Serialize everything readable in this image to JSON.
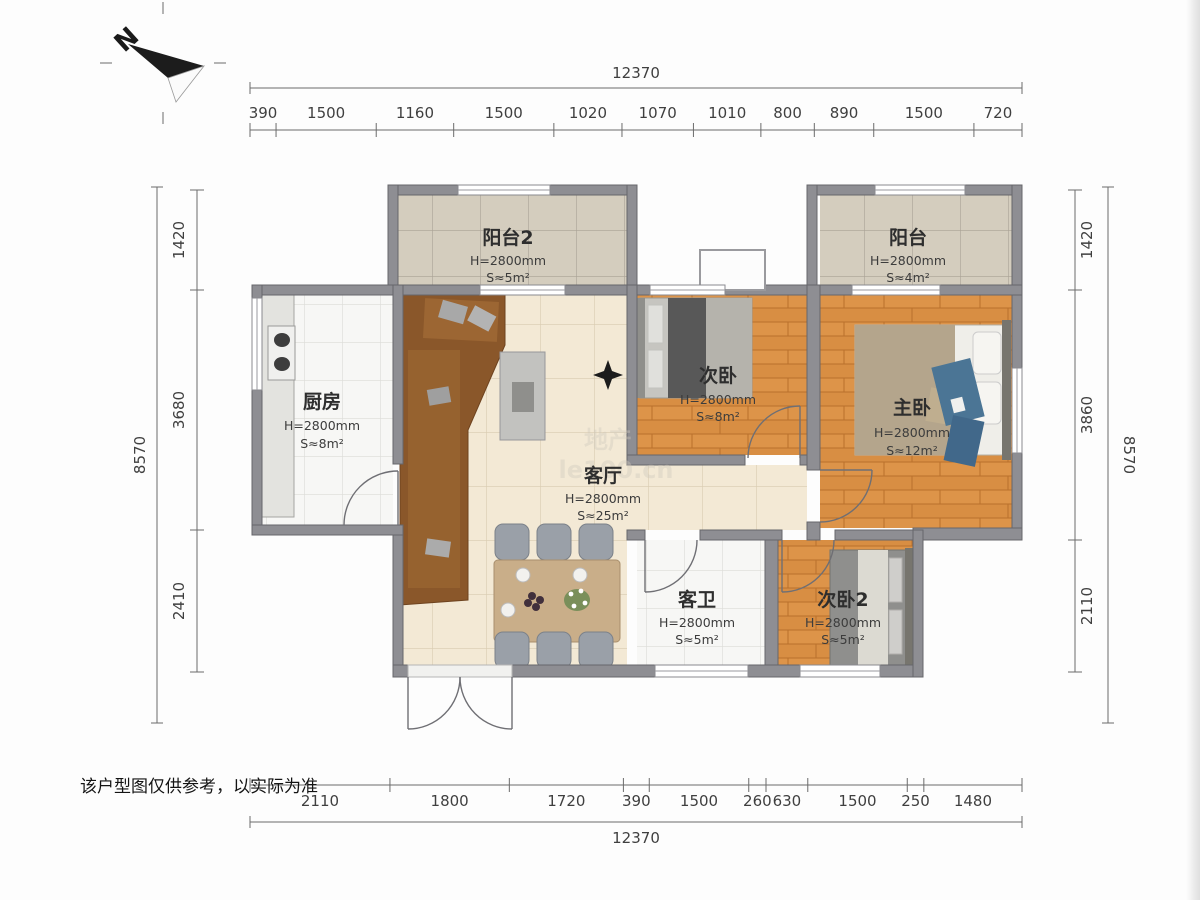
{
  "compass": {
    "n": "N"
  },
  "disclaimer": "该户型图仅供参考，以实际为准",
  "watermark": {
    "line1": "地产",
    "line2": "le100.cn"
  },
  "rooms": {
    "balcony2": {
      "name": "阳台2",
      "height": "H=2800mm",
      "area": "S≈5m²"
    },
    "balcony": {
      "name": "阳台",
      "height": "H=2800mm",
      "area": "S≈4m²"
    },
    "kitchen": {
      "name": "厨房",
      "height": "H=2800mm",
      "area": "S≈8m²"
    },
    "bedroom2": {
      "name": "次卧",
      "height": "H=2800mm",
      "area": "S≈8m²"
    },
    "master": {
      "name": "主卧",
      "height": "H=2800mm",
      "area": "S≈12m²"
    },
    "living": {
      "name": "客厅",
      "height": "H=2800mm",
      "area": "S≈25m²"
    },
    "bath": {
      "name": "客卫",
      "height": "H=2800mm",
      "area": "S≈5m²"
    },
    "bedroom3": {
      "name": "次卧2",
      "height": "H=2800mm",
      "area": "S≈5m²"
    }
  },
  "dimensions": {
    "top": {
      "total": "12370",
      "segments": [
        390,
        1500,
        1160,
        1500,
        1020,
        1070,
        1010,
        800,
        890,
        1500,
        720
      ]
    },
    "bottom": {
      "total": "12370",
      "segments": [
        2110,
        1800,
        1720,
        390,
        1500,
        260,
        630,
        1500,
        250,
        1480
      ]
    },
    "left": {
      "total": "8570",
      "segments": [
        1420,
        3680,
        2410
      ]
    },
    "right": {
      "total": "8570",
      "segments": [
        1420,
        3860,
        2110
      ]
    }
  },
  "colors": {
    "wall": "#8e8e93",
    "wood": "#d88e43",
    "beige_tile": "#f3e9d5",
    "balcony_tile": "#d4cdbe",
    "white_tile": "#f7f7f5",
    "sofa": "#8a572a"
  }
}
